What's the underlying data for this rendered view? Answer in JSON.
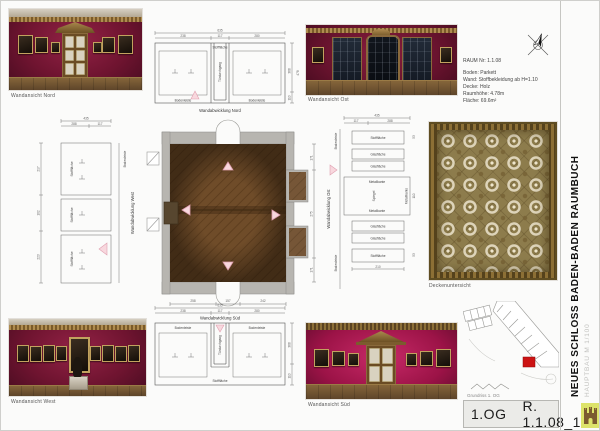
{
  "sheet": {
    "title": "NEUES SCHLOSS BADEN-BADEN RAUMBUCH",
    "subtitle": "HAUPTBAU M 1/100",
    "floor_label": "1.OG",
    "room_label": "R. 1.1.08_1",
    "site_plan_label": "Grundriss 1. OG"
  },
  "room_info": {
    "raum_nr": "RAUM Nr: 1.1.08",
    "boden": "Boden: Parkett",
    "wand": "Wand: Stoffbekleidung ab H=1.10",
    "decke": "Decke: Holz",
    "raumhoehe": "Raumhöhe: 4.78m",
    "flaeche": "Fläche: 69.6m²"
  },
  "captions": {
    "wand_nord": "Wandansicht Nord",
    "wand_ost": "Wandansicht Ost",
    "wand_west": "Wandansicht West",
    "wand_sued": "Wandansicht Süd",
    "abw_nord": "Wandabwicklung Nord",
    "abw_sued": "Wandabwicklung Süd",
    "abw_west": "Wandabwicklung West",
    "abw_ost": "Wandabwicklung Ost",
    "decke": "Deckenuntersicht"
  },
  "labels": {
    "stoffflaeche": "Stofffläche",
    "glasflaeche": "Glasfläche",
    "bodenleiste": "Bodenleiste",
    "metallkante": "Metallkante",
    "spiegel": "Spiegel",
    "tuerdurchgang": "Türdurchgang"
  },
  "dims": {
    "nord_total": "635",
    "nord_left": "238",
    "nord_door": "117",
    "nord_right": "280",
    "nord_h_wand": "368",
    "nord_h_sockel": "110",
    "nord_h_total": "478",
    "sued_total": "635",
    "sued_left": "238",
    "sued_door": "117",
    "sued_right": "280",
    "sued_h_wand": "368",
    "sued_h_sockel": "110",
    "west_total": "435",
    "west_seg1": "288",
    "west_seg2": "117",
    "west_h1": "217",
    "west_h2": "102",
    "west_h3": "223",
    "ost_total": "435",
    "ost_seg1": "117",
    "ost_seg2": "288",
    "ost_h1": "53",
    "ost_h2": "110",
    "ost_h3": "53",
    "ost_b": "210",
    "plan_w1": "258",
    "plan_w2": "157",
    "plan_w3": "242",
    "plan_h1": "171",
    "plan_h2": "275",
    "plan_h3": "171"
  },
  "colors": {
    "wall_crimson": "#6f1430",
    "wall_magenta": "#9c1347",
    "parquet": "#6f4c29",
    "gold": "#9a7b42",
    "marker_pink": "#f8d8de",
    "room_highlight": "#cc1313",
    "stamp_highlight": "#dde36a"
  },
  "icons": {
    "compass": "north-compass",
    "castle": "castle-stamp"
  }
}
